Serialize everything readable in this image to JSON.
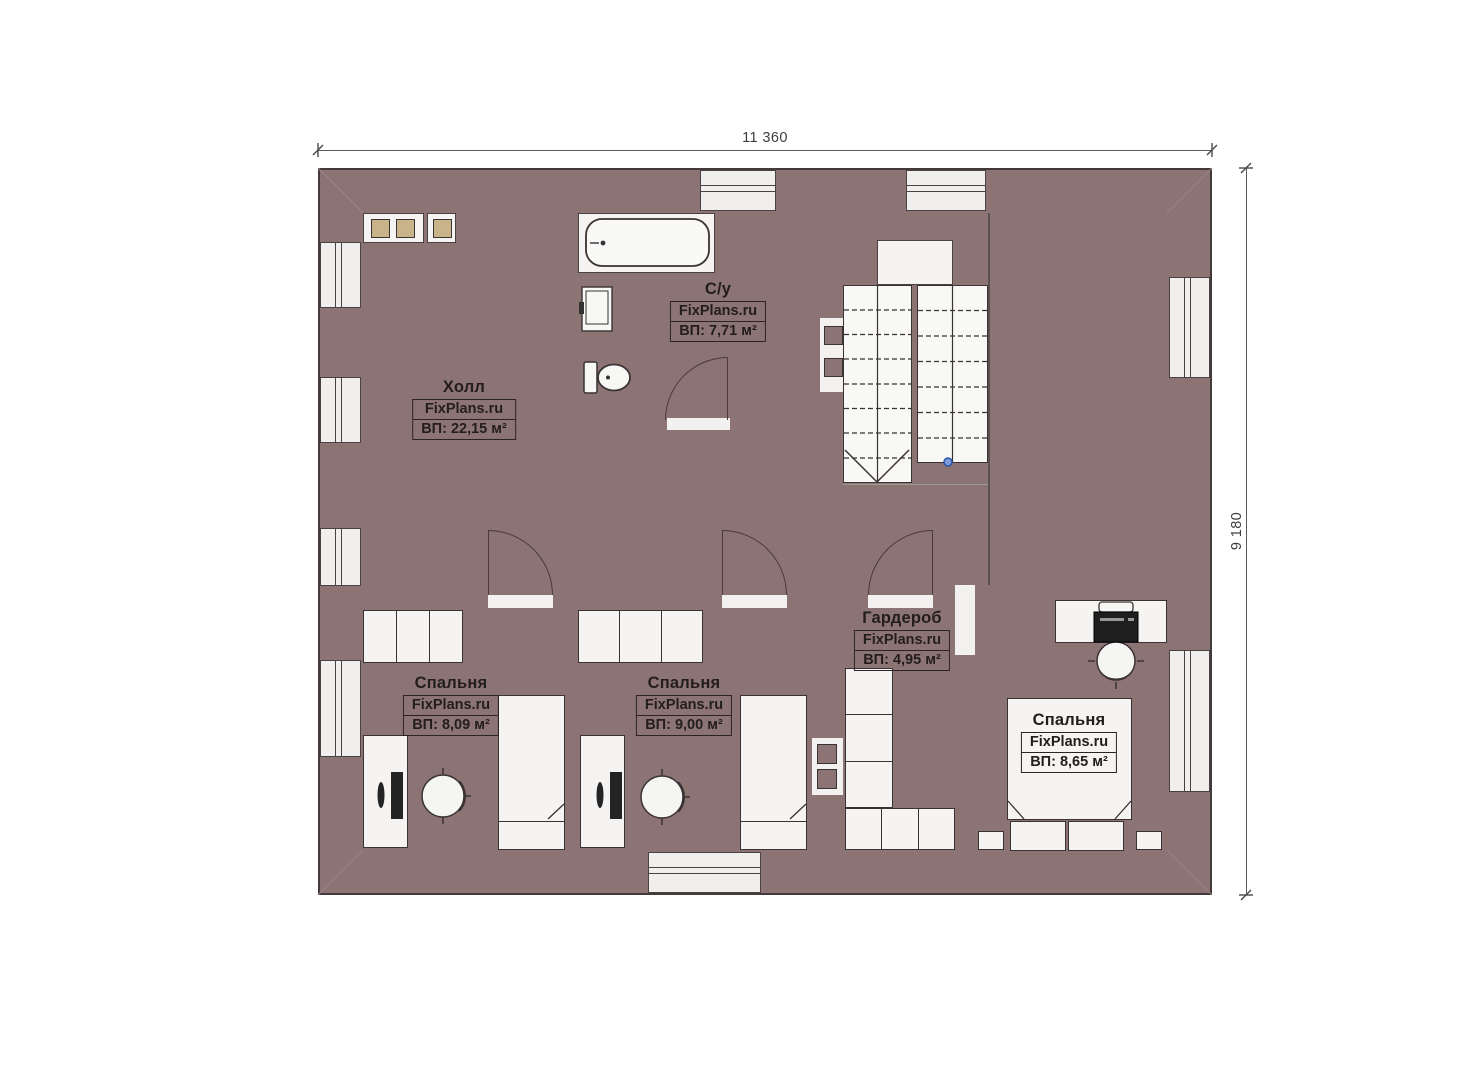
{
  "plan": {
    "dimension_width_label": "11 360",
    "dimension_height_label": "9 180"
  },
  "rooms": [
    {
      "id": "hall",
      "name": "Холл",
      "watermark": "FixPlans.ru",
      "area": "ВП: 22,15 м²"
    },
    {
      "id": "bathroom",
      "name": "С/у",
      "watermark": "FixPlans.ru",
      "area": "ВП: 7,71 м²"
    },
    {
      "id": "wardrobe",
      "name": "Гардероб",
      "watermark": "FixPlans.ru",
      "area": "ВП: 4,95 м²"
    },
    {
      "id": "bedroom-1",
      "name": "Спальня",
      "watermark": "FixPlans.ru",
      "area": "ВП: 8,09 м²"
    },
    {
      "id": "bedroom-2",
      "name": "Спальня",
      "watermark": "FixPlans.ru",
      "area": "ВП: 9,00 м²"
    },
    {
      "id": "bedroom-3",
      "name": "Спальня",
      "watermark": "FixPlans.ru",
      "area": "ВП: 8,65 м²"
    }
  ],
  "colors": {
    "wall": "#8c7475",
    "hall_floor": "#d2bd92",
    "bath_floor": "#badbf4",
    "bedroom_floor": "#8a7153",
    "outline": "#3a3233",
    "stair_marker_blue": "#7b9bd9"
  }
}
